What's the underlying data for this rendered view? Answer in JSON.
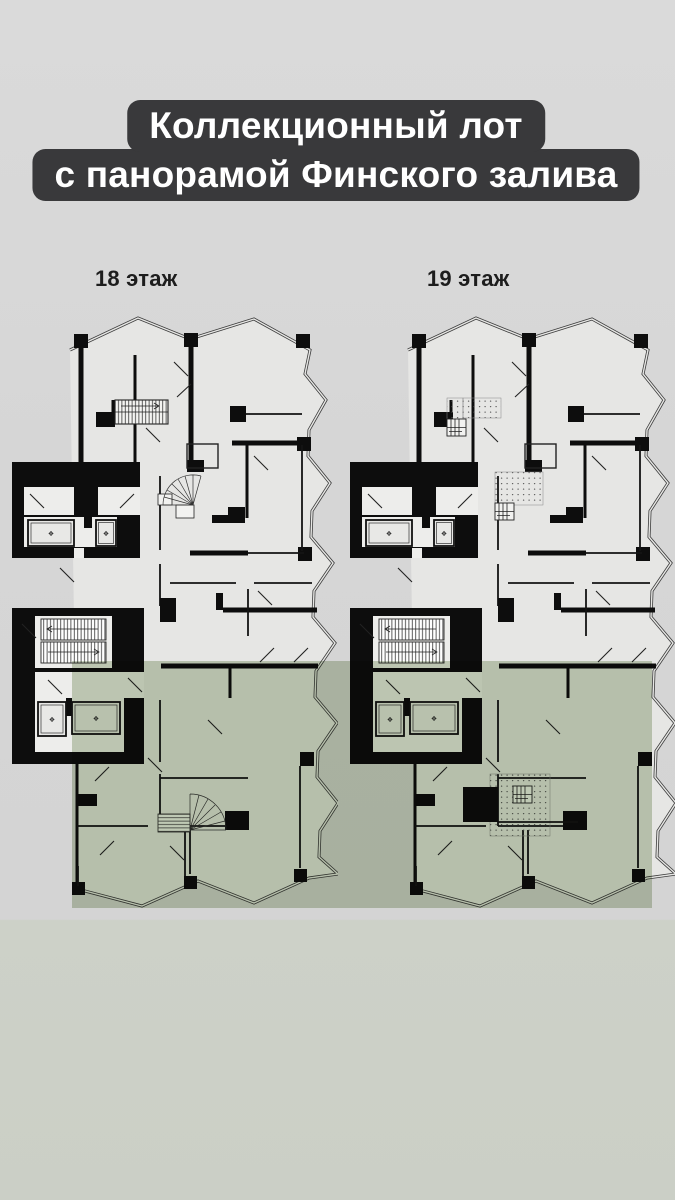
{
  "title": {
    "line1": "Коллекционный лот",
    "line2": "с панорамой Финского залива",
    "background": "#39393b",
    "text_color": "#ffffff"
  },
  "plans": [
    {
      "label": "18 этаж"
    },
    {
      "label": "19 этаж"
    }
  ],
  "highlight": {
    "color": "rgba(150,170,130,0.5)"
  },
  "icons": {
    "elevator": "❖"
  },
  "colors": {
    "background_top": "#dadada",
    "background_bottom_band": "#cdd1c8",
    "plan_paper": "#e6e6e4",
    "walls": "#0d0d0d"
  }
}
